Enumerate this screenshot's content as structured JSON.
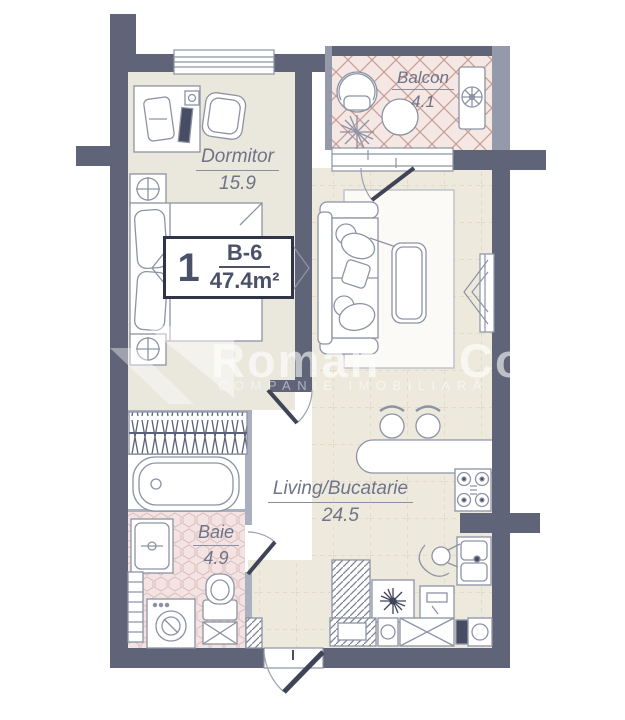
{
  "plan": {
    "unit": {
      "number": "1",
      "code": "B-6",
      "area": "47.4m²"
    },
    "rooms": [
      {
        "id": "dormitor",
        "name": "Dormitor",
        "area": "15.9"
      },
      {
        "id": "balcon",
        "name": "Balcon",
        "area": "4.1"
      },
      {
        "id": "living",
        "name": "Living/Bucatarie",
        "area": "24.5"
      },
      {
        "id": "baie",
        "name": "Baie",
        "area": "4.9"
      }
    ],
    "watermark": {
      "brand_left": "Roman",
      "brand_right": "Co",
      "tagline": "COMPANIE IMOBILIARĂ"
    },
    "colors": {
      "wall": "#5f6478",
      "wall_light": "#959aab",
      "bedroom_floor": "#eae7dc",
      "living_tile": "#edeadd",
      "balcony_tile": "#f4e7e4",
      "bath_tile": "#f3e3e2",
      "line": "#8d93a3",
      "accent_dark": "#474d62",
      "label_text": "#6f7488"
    }
  }
}
